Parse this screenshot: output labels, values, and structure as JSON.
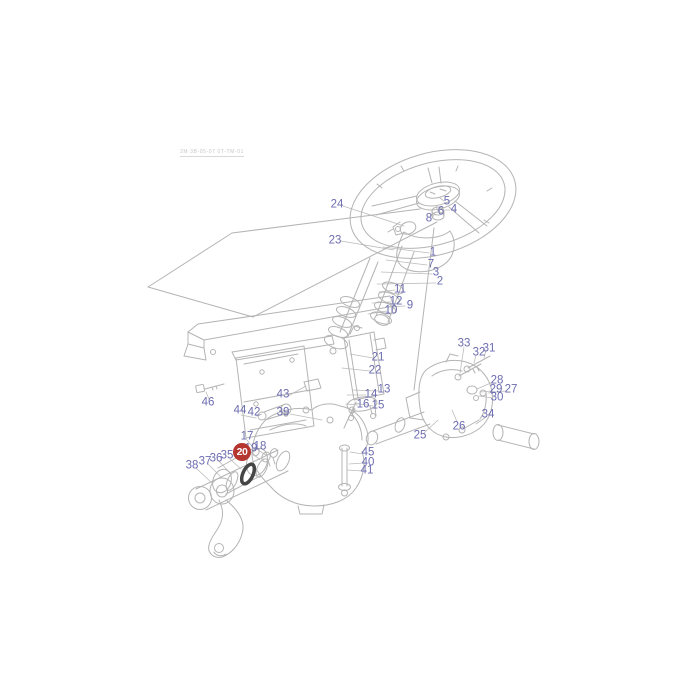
{
  "page": {
    "background": "#ffffff",
    "ref_text": "2M 3B-05-07 0T-TM-01"
  },
  "diagram": {
    "description": "Exploded parts diagram of a tractor steering column, steering wheel and steering box assembly",
    "label_color": "#6c6cb0",
    "line_color": "#b4b4b4",
    "highlight": {
      "number": "20",
      "x": 242,
      "y": 452,
      "bg_color": "#b5362e",
      "text_color": "#ffffff"
    },
    "part_labels": [
      {
        "n": "1",
        "x": 433,
        "y": 253
      },
      {
        "n": "2",
        "x": 440,
        "y": 282
      },
      {
        "n": "3",
        "x": 436,
        "y": 273
      },
      {
        "n": "4",
        "x": 454,
        "y": 210
      },
      {
        "n": "5",
        "x": 447,
        "y": 202
      },
      {
        "n": "6",
        "x": 441,
        "y": 212
      },
      {
        "n": "7",
        "x": 431,
        "y": 265
      },
      {
        "n": "8",
        "x": 429,
        "y": 219
      },
      {
        "n": "9",
        "x": 410,
        "y": 306
      },
      {
        "n": "10",
        "x": 391,
        "y": 311
      },
      {
        "n": "11",
        "x": 400,
        "y": 290
      },
      {
        "n": "12",
        "x": 396,
        "y": 302
      },
      {
        "n": "13",
        "x": 384,
        "y": 390
      },
      {
        "n": "14",
        "x": 371,
        "y": 395
      },
      {
        "n": "15",
        "x": 378,
        "y": 406
      },
      {
        "n": "16",
        "x": 363,
        "y": 405
      },
      {
        "n": "17",
        "x": 247,
        "y": 437
      },
      {
        "n": "18",
        "x": 260,
        "y": 447
      },
      {
        "n": "19",
        "x": 251,
        "y": 449
      },
      {
        "n": "21",
        "x": 378,
        "y": 358
      },
      {
        "n": "22",
        "x": 375,
        "y": 371
      },
      {
        "n": "23",
        "x": 335,
        "y": 241
      },
      {
        "n": "24",
        "x": 337,
        "y": 205
      },
      {
        "n": "25",
        "x": 420,
        "y": 436
      },
      {
        "n": "26",
        "x": 459,
        "y": 427
      },
      {
        "n": "27",
        "x": 511,
        "y": 390
      },
      {
        "n": "28",
        "x": 497,
        "y": 381
      },
      {
        "n": "29",
        "x": 496,
        "y": 390
      },
      {
        "n": "30",
        "x": 497,
        "y": 398
      },
      {
        "n": "31",
        "x": 489,
        "y": 349
      },
      {
        "n": "32",
        "x": 479,
        "y": 353
      },
      {
        "n": "33",
        "x": 464,
        "y": 344
      },
      {
        "n": "34",
        "x": 488,
        "y": 415
      },
      {
        "n": "35",
        "x": 227,
        "y": 456
      },
      {
        "n": "36",
        "x": 216,
        "y": 459
      },
      {
        "n": "37",
        "x": 205,
        "y": 462
      },
      {
        "n": "38",
        "x": 192,
        "y": 466
      },
      {
        "n": "39",
        "x": 283,
        "y": 413
      },
      {
        "n": "40",
        "x": 368,
        "y": 463
      },
      {
        "n": "41",
        "x": 367,
        "y": 471
      },
      {
        "n": "42",
        "x": 254,
        "y": 413
      },
      {
        "n": "43",
        "x": 283,
        "y": 395
      },
      {
        "n": "44",
        "x": 240,
        "y": 411
      },
      {
        "n": "45",
        "x": 368,
        "y": 453
      },
      {
        "n": "46",
        "x": 208,
        "y": 403
      }
    ]
  }
}
